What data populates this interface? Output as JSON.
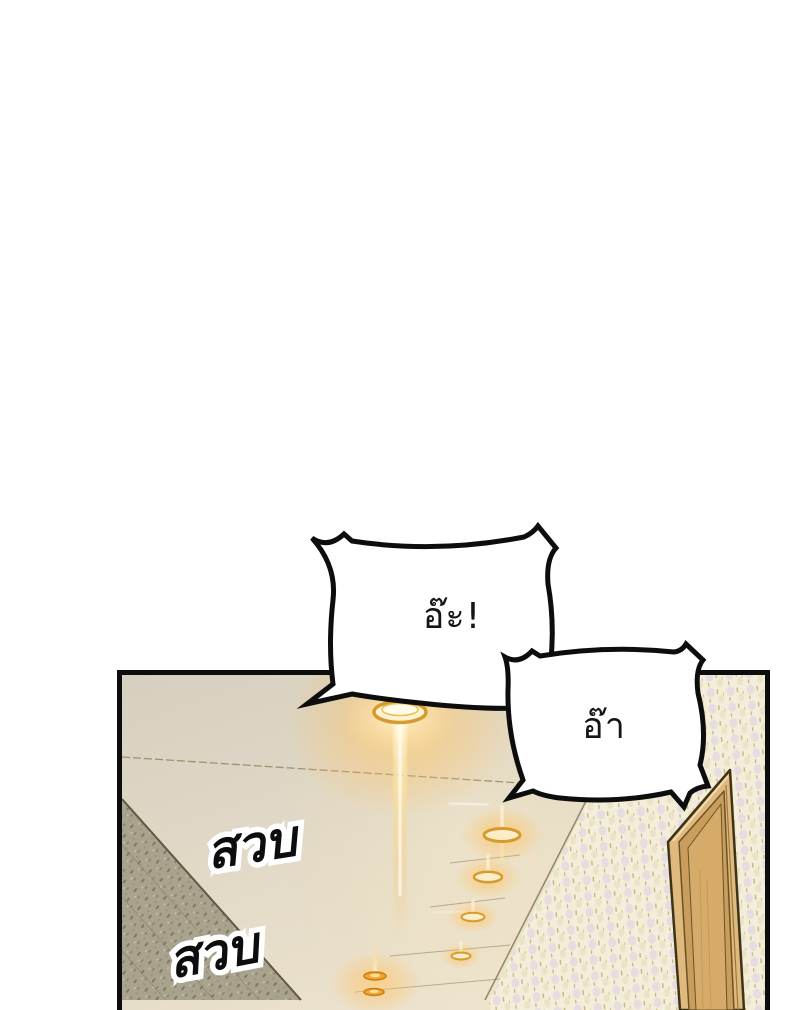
{
  "page": {
    "background_color": "#ffffff"
  },
  "panel": {
    "border_color": "#0d0d0d",
    "scene": "hallway ceiling in perspective with a row of glowing recessed lights, speckled walls and a tilted wooden door",
    "colors": {
      "ceiling_base": "#d6cfc0",
      "ceiling_warm": "#efe5cf",
      "light_ring": "#d69b2e",
      "light_glow": "#ffb84d",
      "left_wall": "#a9a28d",
      "right_wall": "#f3eed9",
      "door": "#dfb97d"
    }
  },
  "bubbles": [
    {
      "id": "bubble-1",
      "text": "อ๊ะ!"
    },
    {
      "id": "bubble-2",
      "text": "อ๊า"
    }
  ],
  "sfx": [
    {
      "id": "sfx-1",
      "text": "สวบ"
    },
    {
      "id": "sfx-2",
      "text": "สวบ"
    }
  ]
}
